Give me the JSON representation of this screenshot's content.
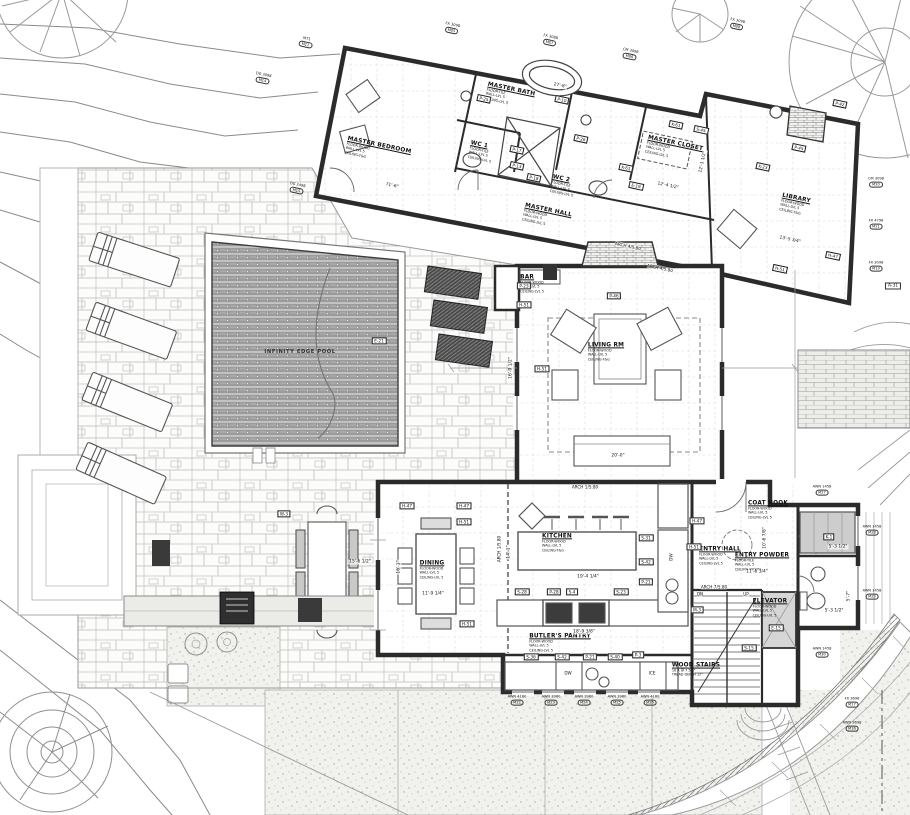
{
  "rooms": {
    "master_bedroom": {
      "name": "MASTER BEDROOM",
      "finishes": [
        "FLOOR-WOOD",
        "WALL-LVL 5",
        "CEILING-T&G"
      ]
    },
    "wc1": {
      "name": "WC 1",
      "finishes": [
        "FLOOR-TILE",
        "WALL-LVL 5",
        "CEILING-LVL 5"
      ]
    },
    "master_bath": {
      "name": "MASTER BATH",
      "finishes": [
        "FLOOR-TILE",
        "WALL-LVL 5",
        "CEILING-LVL 5"
      ]
    },
    "wc2": {
      "name": "WC 2",
      "finishes": [
        "FLOOR-TILE",
        "WALL-LVL 5",
        "CEILING-LVL 5"
      ]
    },
    "master_closet": {
      "name": "MASTER CLOSET",
      "finishes": [
        "FLOOR-WOOD",
        "WALL-LVL 5",
        "CEILING-LVL 5"
      ]
    },
    "library": {
      "name": "LIBRARY",
      "finishes": [
        "FLOOR-WOOD",
        "WALL-LVL 5",
        "CEILING-T&G"
      ]
    },
    "master_hall": {
      "name": "MASTER HALL",
      "finishes": [
        "FLOOR-WOOD",
        "WALL-LVL 5",
        "CEILING-LVL 5"
      ]
    },
    "bar": {
      "name": "BAR",
      "finishes": [
        "FLOOR-WOOD",
        "WALL-LVL 5",
        "CEILING-LVL 5"
      ]
    },
    "living": {
      "name": "LIVING RM",
      "finishes": [
        "FLOOR-WOOD",
        "WALL-LVL 5",
        "CEILING-T&G"
      ]
    },
    "dining": {
      "name": "DINING",
      "finishes": [
        "FLOOR-WOOD",
        "WALL-LVL 5",
        "CEILING-LVL 5"
      ]
    },
    "kitchen": {
      "name": "KITCHEN",
      "finishes": [
        "FLOOR-WOOD",
        "WALL-LVL 5",
        "CEILING-T&G"
      ]
    },
    "butlers": {
      "name": "BUTLER'S PANTRY",
      "finishes": [
        "FLOOR-WOOD",
        "WALL-LVL 5",
        "CEILING-LVL 5"
      ]
    },
    "entry_hall": {
      "name": "ENTRY HALL",
      "finishes": [
        "FLOOR-WOOD",
        "WALL-LVL 5",
        "CEILING-LVL 5"
      ]
    },
    "coat_nook": {
      "name": "COAT NOOK",
      "finishes": [
        "FLOOR-WOOD",
        "WALL-LVL 5",
        "CEILING-LVL 5"
      ]
    },
    "entry_powder": {
      "name": "ENTRY POWDER",
      "finishes": [
        "FLOOR-TILE",
        "WALL-LVL 5",
        "CEILING-WOOD"
      ]
    },
    "elevator": {
      "name": "ELEVATOR",
      "finishes": [
        "FLOOR-WOOD",
        "WALL-LVL 5",
        "CEILING-LVL 5"
      ]
    }
  },
  "stairs": {
    "label": "WOOD STAIRS",
    "note1": "16 R @ 7 5/8\"",
    "note2": "TREAD DEPTH 12\""
  },
  "pool": {
    "label": "INFINITY EDGE POOL"
  },
  "ref_tags": [
    {
      "t": "P-25",
      "x": 484,
      "y": 99,
      "r": 12
    },
    {
      "t": "P-10",
      "x": 562,
      "y": 100,
      "r": 12
    },
    {
      "t": "P-17",
      "x": 517,
      "y": 150,
      "r": 12
    },
    {
      "t": "P-13",
      "x": 517,
      "y": 166,
      "r": 12
    },
    {
      "t": "P-18",
      "x": 534,
      "y": 178,
      "r": 12
    },
    {
      "t": "P-26",
      "x": 581,
      "y": 139,
      "r": 12
    },
    {
      "t": "K-61",
      "x": 676,
      "y": 125,
      "r": 12
    },
    {
      "t": "S-45",
      "x": 701,
      "y": 130,
      "r": 12
    },
    {
      "t": "K-61",
      "x": 626,
      "y": 168,
      "r": 12
    },
    {
      "t": "E-19",
      "x": 636,
      "y": 186,
      "r": 12
    },
    {
      "t": "K-23",
      "x": 763,
      "y": 167,
      "r": 12
    },
    {
      "t": "P-45",
      "x": 799,
      "y": 148,
      "r": 12
    },
    {
      "t": "P-42",
      "x": 840,
      "y": 104,
      "r": 12
    },
    {
      "t": "H-47",
      "x": 833,
      "y": 256,
      "r": 12
    },
    {
      "t": "H-51",
      "x": 780,
      "y": 269,
      "r": 12
    },
    {
      "t": "P-23",
      "x": 524,
      "y": 286
    },
    {
      "t": "H-51",
      "x": 524,
      "y": 305
    },
    {
      "t": "H-51",
      "x": 542,
      "y": 369
    },
    {
      "t": "P-46",
      "x": 614,
      "y": 296
    },
    {
      "t": "H-47",
      "x": 407,
      "y": 506
    },
    {
      "t": "H-47",
      "x": 464,
      "y": 506
    },
    {
      "t": "H-51",
      "x": 464,
      "y": 522
    },
    {
      "t": "H-51",
      "x": 467,
      "y": 624
    },
    {
      "t": "S-31",
      "x": 646,
      "y": 538
    },
    {
      "t": "S-42",
      "x": 646,
      "y": 562
    },
    {
      "t": "P-21",
      "x": 646,
      "y": 582
    },
    {
      "t": "S-28",
      "x": 522,
      "y": 592
    },
    {
      "t": "P-28",
      "x": 554,
      "y": 592
    },
    {
      "t": "S-4",
      "x": 572,
      "y": 592
    },
    {
      "t": "S-23",
      "x": 621,
      "y": 592
    },
    {
      "t": "S-36",
      "x": 531,
      "y": 657
    },
    {
      "t": "S-42",
      "x": 562,
      "y": 657
    },
    {
      "t": "P-21",
      "x": 590,
      "y": 657
    },
    {
      "t": "S-40",
      "x": 615,
      "y": 657
    },
    {
      "t": "P-3",
      "x": 638,
      "y": 655
    },
    {
      "t": "S-15",
      "x": 749,
      "y": 648
    },
    {
      "t": "H-47",
      "x": 697,
      "y": 521
    },
    {
      "t": "H-51",
      "x": 694,
      "y": 547
    },
    {
      "t": "K-1",
      "x": 829,
      "y": 537
    },
    {
      "t": "M-3",
      "x": 697,
      "y": 610
    },
    {
      "t": "E-15",
      "x": 776,
      "y": 628
    },
    {
      "t": "E-21",
      "x": 379,
      "y": 341
    },
    {
      "t": "W-3",
      "x": 284,
      "y": 514
    }
  ],
  "dimensions": [
    {
      "t": "71'-6\"",
      "x": 392,
      "y": 186,
      "r": 12
    },
    {
      "t": "27'-8\"",
      "x": 560,
      "y": 86,
      "r": 12
    },
    {
      "t": "12'-4 1/2\"",
      "x": 668,
      "y": 186,
      "r": 12
    },
    {
      "t": "12'-1 1/2\"",
      "x": 703,
      "y": 162,
      "r": -78
    },
    {
      "t": "13'-5 3/4\"",
      "x": 790,
      "y": 240,
      "r": 12
    },
    {
      "t": "20'-0\"",
      "x": 618,
      "y": 456
    },
    {
      "t": "16'-9 1/2\"",
      "x": 511,
      "y": 368,
      "r": -90
    },
    {
      "t": "19'-4 1/4\"",
      "x": 588,
      "y": 577
    },
    {
      "t": "14'-1\"",
      "x": 509,
      "y": 552,
      "r": -90
    },
    {
      "t": "11'-9 1/4\"",
      "x": 433,
      "y": 594
    },
    {
      "t": "18'-9 3/8\"",
      "x": 584,
      "y": 632
    },
    {
      "t": "11'-6 3/4\"",
      "x": 757,
      "y": 572
    },
    {
      "t": "10'-6 7/8\"",
      "x": 765,
      "y": 538,
      "r": -90
    },
    {
      "t": "5'-3 1/2\"",
      "x": 838,
      "y": 547
    },
    {
      "t": "5'-3 1/2\"",
      "x": 834,
      "y": 611
    },
    {
      "t": "5'-7\"",
      "x": 849,
      "y": 596,
      "r": -90
    },
    {
      "t": "16'-1\"",
      "x": 399,
      "y": 567,
      "r": -90
    },
    {
      "t": "15'-6 1/2\"",
      "x": 360,
      "y": 562
    }
  ],
  "window_tags": [
    {
      "l1": "AWN 4160",
      "l2": "M22",
      "x": 517,
      "y": 700
    },
    {
      "l1": "AWN 3960",
      "l2": "M23",
      "x": 551,
      "y": 700
    },
    {
      "l1": "AWN 3960",
      "l2": "M24",
      "x": 584,
      "y": 700
    },
    {
      "l1": "AWN 3960",
      "l2": "M25",
      "x": 617,
      "y": 700
    },
    {
      "l1": "AWN 4160",
      "l2": "M26",
      "x": 650,
      "y": 700
    },
    {
      "l1": "AWN 1458",
      "l2": "M27",
      "x": 822,
      "y": 490
    },
    {
      "l1": "AWN 1458",
      "l2": "M28",
      "x": 872,
      "y": 530
    },
    {
      "l1": "AWN 1458",
      "l2": "M29",
      "x": 872,
      "y": 594
    },
    {
      "l1": "AWN 1458",
      "l2": "M30",
      "x": 822,
      "y": 652
    },
    {
      "l1": "CM 3098",
      "l2": "M20",
      "x": 876,
      "y": 182
    },
    {
      "l1": "FX 4798",
      "l2": "M21",
      "x": 876,
      "y": 224
    },
    {
      "l1": "FX 3098",
      "l2": "M19",
      "x": 876,
      "y": 266
    },
    {
      "l1": "FX 3698",
      "l2": "M17",
      "x": 852,
      "y": 702
    },
    {
      "l1": "AWN 3698",
      "l2": "M16",
      "x": 852,
      "y": 726
    },
    {
      "l1": "FX 3098",
      "l2": "M05",
      "x": 452,
      "y": 28,
      "r": 12
    },
    {
      "l1": "FX 3088",
      "l2": "M07",
      "x": 550,
      "y": 40,
      "r": 12
    },
    {
      "l1": "CM 3098",
      "l2": "M06",
      "x": 630,
      "y": 54,
      "r": 12
    },
    {
      "l1": "FX 3098",
      "l2": "M08",
      "x": 737,
      "y": 24,
      "r": 12
    },
    {
      "l1": "DG 2498",
      "l2": "M15",
      "x": 297,
      "y": 188,
      "r": 12
    },
    {
      "l1": "DG 3098",
      "l2": "M14",
      "x": 263,
      "y": 78,
      "r": 12
    },
    {
      "l1": "MT1",
      "l2": "M11",
      "x": 306,
      "y": 42,
      "r": 12
    }
  ],
  "notes": [
    {
      "t": "ARCH 4/5.80",
      "x": 628,
      "y": 246,
      "r": 12
    },
    {
      "t": "ARCH 4/5.80",
      "x": 660,
      "y": 268,
      "r": 12
    },
    {
      "t": "ARCH 1/5.80",
      "x": 585,
      "y": 487
    },
    {
      "t": "ARCH 1/5.80",
      "x": 499,
      "y": 549,
      "r": -90
    },
    {
      "t": "ARCH 7/5.80",
      "x": 714,
      "y": 587
    },
    {
      "t": "DN",
      "x": 700,
      "y": 594
    },
    {
      "t": "UP",
      "x": 746,
      "y": 594
    },
    {
      "t": "DW",
      "x": 671,
      "y": 557,
      "r": -90
    },
    {
      "t": "DW",
      "x": 568,
      "y": 673
    },
    {
      "t": "ICE",
      "x": 652,
      "y": 673
    },
    {
      "t": "A-31",
      "x": 893,
      "y": 286,
      "b": true
    }
  ],
  "colors": {
    "wall": "#2b2b2b",
    "water": "#9b9b9b",
    "stone_joint": "#c8c8c6",
    "stipple_dot": "#a9a9a2",
    "paper": "#ffffff"
  }
}
